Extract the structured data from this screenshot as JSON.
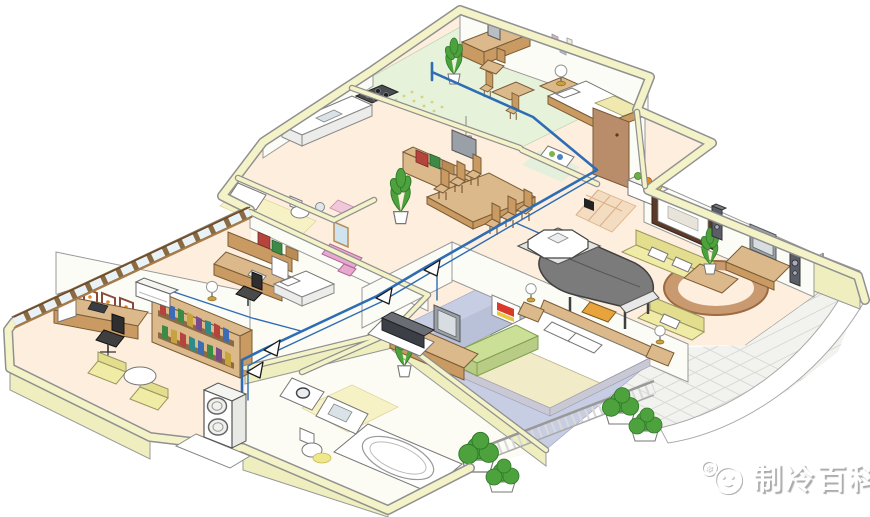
{
  "watermark": {
    "text": "制冷百科",
    "icon": "❄"
  },
  "colors": {
    "pipe_blue": "#2e6db5",
    "wall_fill": "#f4f3c8",
    "wall_edge": "#909090",
    "floor_cream": "#fdeedd",
    "floor_green": "#e6f2da",
    "carpet_blue": "#c7cde2",
    "tile_yellow": "#f7f2c6",
    "tile_entry": "#f3dcc0",
    "balcony_gray": "#f2f2ee",
    "wood_light": "#dcb98a",
    "wood_mid": "#c99a62",
    "sofa_yellow": "#f0eca6",
    "sofa_green": "#cbdf97",
    "piano_gray": "#7b7b7b",
    "plant_green": "#4ea23e",
    "unit_white": "#ffffff",
    "watermark_white": "#ffffff"
  }
}
